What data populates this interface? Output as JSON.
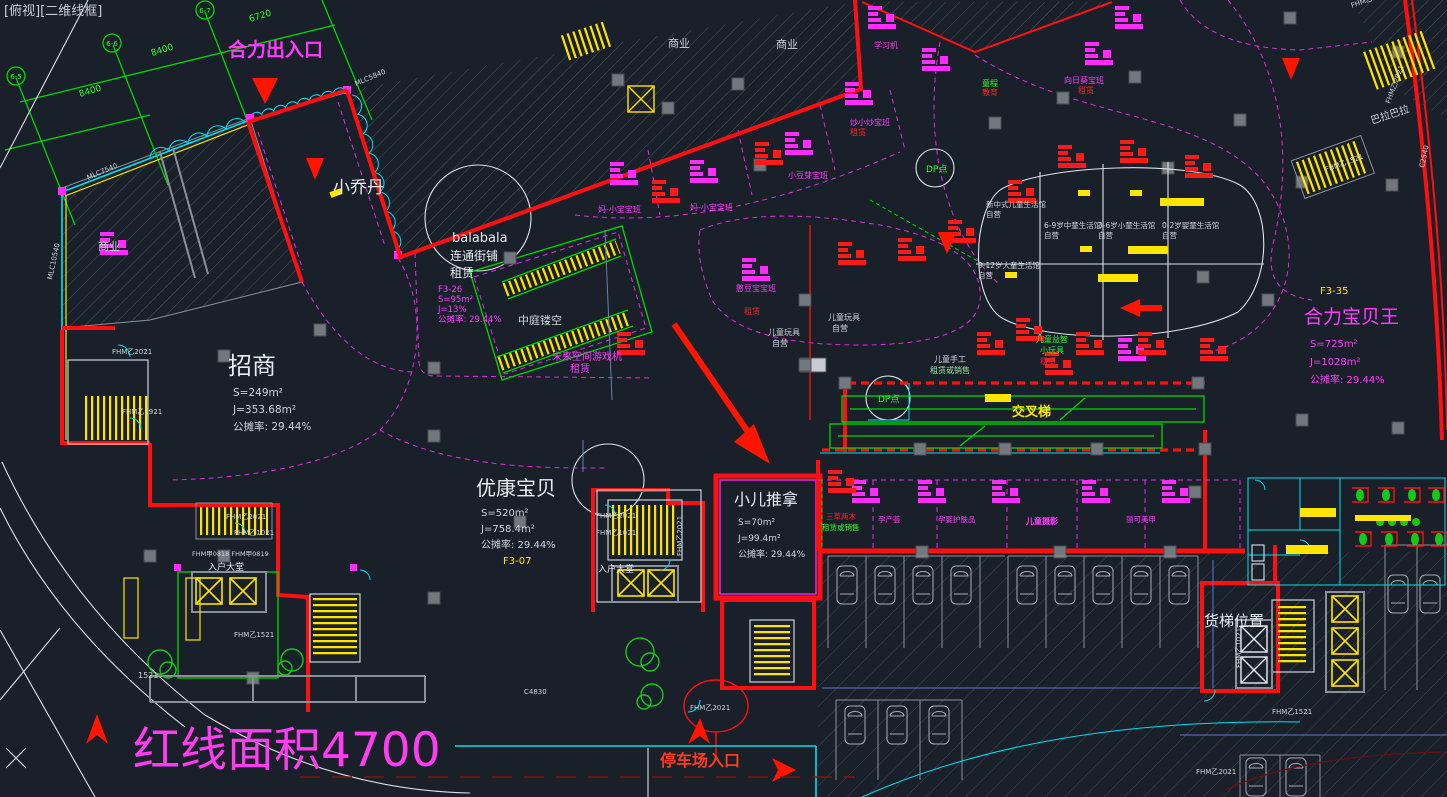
{
  "viewport_label": "[俯视][二维线框]",
  "colors": {
    "background": "#1a202a",
    "red_line": "#ff0f0f",
    "magenta": "#ff2bff",
    "cyan": "#00e0f0",
    "green": "#00d800",
    "yellow": "#ffe400",
    "white": "#e8ecf1",
    "column_gray": "#73787f"
  },
  "grid": {
    "bubble_1": "6-7",
    "bubble_2": "6-6",
    "bubble_3": "6-5",
    "dim_8400": "8400",
    "dim_6720": "6720"
  },
  "walls": {
    "mlc7540": "MLC7540",
    "mlc5840": "MLC5840",
    "mlc10540": "MLC10540",
    "c2540": "C2540",
    "c4830": "C4830",
    "tag_1521": "1521"
  },
  "doors": {
    "fhm_y2021": "FHM乙2021",
    "fhm_y1021": "FHM乙1021",
    "fhm_y1521": "FHM乙1521",
    "fhm_y1921": "FHM乙1921",
    "fhm_j0818": "FHM甲0818 FHM甲0819"
  },
  "annotations": {
    "entrance": "合力出入口",
    "red_line_area": "红线面积4700",
    "parking_entrance": "停车场入口",
    "freight_elevator_location": "货梯位置",
    "cross_escalator": "交叉梯",
    "atrium_void": "中庭镂空",
    "entry_lobby": "入户大堂",
    "dp_point": "DP点",
    "commercial": "商业",
    "future_space": "未来空间游戏机",
    "lease": "租赁",
    "lease_or_sale": "租赁或销售",
    "self_operated": "自营"
  },
  "tenants": {
    "xiao_qiao_dan": "小乔丹",
    "bala_block": "巴拉巴拉",
    "balabala": {
      "line1": "balabala",
      "line2": "连通街铺",
      "line3": "租赁",
      "code": "F3-26",
      "s": "S=95m²",
      "j": "J=13%",
      "share": "公摊率: 29.44%"
    },
    "zhao_shang": {
      "name": "招商",
      "s": "S=249m²",
      "j": "J=353.68m²",
      "share": "公摊率: 29.44%"
    },
    "you_kang": {
      "name": "优康宝贝",
      "s": "S=520m²",
      "j": "J=758.4m²",
      "share": "公摊率: 29.44%",
      "code": "F3-07"
    },
    "tui_na": {
      "name": "小儿推拿",
      "s": "S=70m²",
      "j": "J=99.4m²",
      "share": "公摊率: 29.44%"
    },
    "bao_bei_wang": {
      "name": "合力宝贝王",
      "s": "S=725m²",
      "j": "J=1028m²",
      "share": "公摊率: 29.44%",
      "code": "F3-35"
    }
  },
  "classrooms": {
    "c1": "妈-小宝宝班",
    "c2": "妈-小宝宝班",
    "c3": "小豆芽宝班",
    "c4": "炒小炒宝班",
    "c5": "童程",
    "c5b": "教育",
    "c6": "向日葵宝班",
    "c7": "学习机",
    "c8": "憨豆宝宝班"
  },
  "life_halls": {
    "h1": "新中式儿童生活馆",
    "h2": "9-12岁大童生活馆",
    "h3": "6-9岁中童生活馆",
    "h4": "3-6岁小童生活馆",
    "h5": "0-2岁婴童生活馆"
  },
  "kids_zones": {
    "toys": "儿童玩具",
    "handcraft": "儿童手工",
    "puzzle": "儿童益智",
    "small_toys": "小玩具"
  },
  "shops": {
    "s1": "三草两木",
    "s2": "孕产荟",
    "s3": "孕婴护肤品",
    "s4": "儿童摄影",
    "s5": "丽可美甲"
  }
}
